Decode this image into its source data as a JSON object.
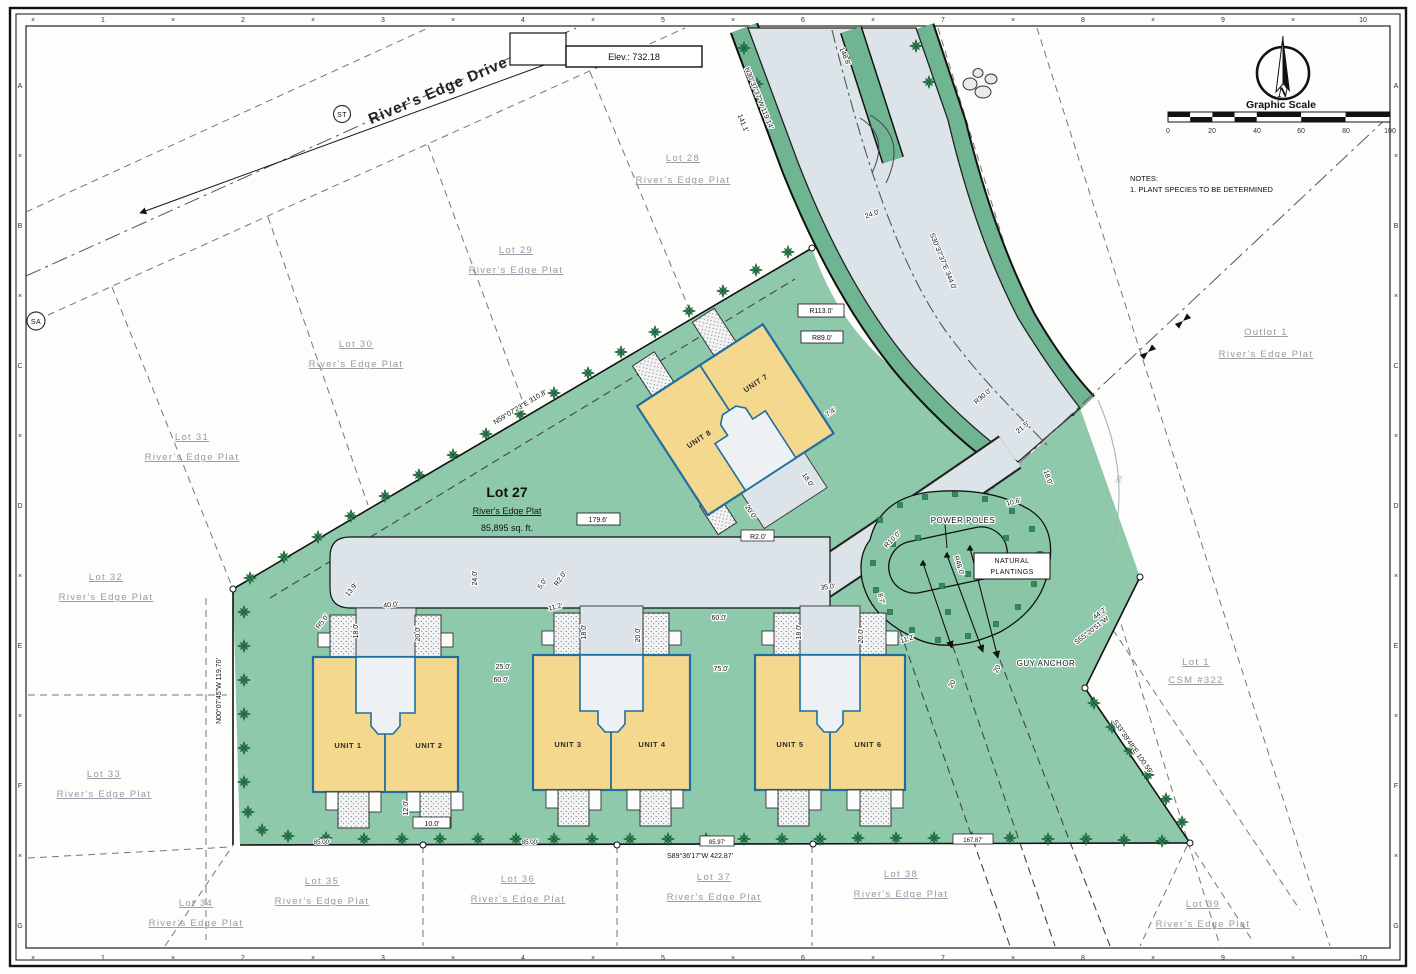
{
  "colors": {
    "lot_green": "#8fc9ab",
    "road_verge": "#6fb592",
    "pavement": "#dce4ea",
    "building": "#f4d88e",
    "building_outline": "#1f6f9e",
    "tree": "#2f8d57"
  },
  "frame": {
    "cross": "×",
    "top_numbers": [
      "1",
      "2",
      "3",
      "4",
      "5",
      "6",
      "7",
      "8",
      "9",
      "10"
    ],
    "side_letters": [
      "A",
      "B",
      "C",
      "D",
      "E",
      "F",
      "G"
    ]
  },
  "street": {
    "name": "River's Edge Drive",
    "st": "ST",
    "sa": "SA"
  },
  "benchmark": {
    "elevation": "Elev.: 732.18"
  },
  "north": {
    "n": "N"
  },
  "scale": {
    "title": "Graphic Scale",
    "ticks": [
      "0",
      "20",
      "40",
      "60",
      "80",
      "100"
    ]
  },
  "notes": {
    "heading": "NOTES:",
    "item1": "1.   PLANT SPECIES TO BE DETERMINED"
  },
  "lot27": {
    "name": "Lot 27",
    "plat": "River's Edge Plat",
    "area": "85,895 sq. ft."
  },
  "units": {
    "u1": "UNIT 1",
    "u2": "UNIT 2",
    "u3": "UNIT 3",
    "u4": "UNIT 4",
    "u5": "UNIT 5",
    "u6": "UNIT 6",
    "u7": "UNIT 7",
    "u8": "UNIT 8"
  },
  "features": {
    "power_poles": "POWER POLES",
    "natural_1": "NATURAL",
    "natural_2": "PLANTINGS",
    "guy_anchor": "GUY ANCHOR",
    "contour": "90"
  },
  "lots": {
    "lot28": {
      "name": "Lot 28",
      "plat": "River's Edge Plat"
    },
    "lot29": {
      "name": "Lot 29",
      "plat": "River's Edge Plat"
    },
    "lot30": {
      "name": "Lot 30",
      "plat": "River's Edge Plat"
    },
    "lot31": {
      "name": "Lot 31",
      "plat": "River's Edge Plat"
    },
    "lot32": {
      "name": "Lot 32",
      "plat": "River's Edge Plat"
    },
    "lot33": {
      "name": "Lot 33",
      "plat": "River's Edge Plat"
    },
    "lot34": {
      "name": "Lot 34",
      "plat": "River's Edge Plat"
    },
    "lot35": {
      "name": "Lot 35",
      "plat": "River's Edge Plat"
    },
    "lot36": {
      "name": "Lot 36",
      "plat": "River's Edge Plat"
    },
    "lot37": {
      "name": "Lot 37",
      "plat": "River's Edge Plat"
    },
    "lot38": {
      "name": "Lot 38",
      "plat": "River's Edge Plat"
    },
    "lot39": {
      "name": "Lot 39",
      "plat": "River's Edge Plat"
    },
    "outlot": {
      "name": "Outlot 1",
      "plat": "River's Edge Plat"
    },
    "lot1": {
      "name": "Lot 1",
      "plat": "CSM #322"
    }
  },
  "dims": {
    "road_len_148_8": "148.8'",
    "brg_nw": "N30°37'37\"W  119.14'",
    "len_141_1": "141.1'",
    "width_24_road": "24.0'",
    "brg_se_road": "S30°37'37\"E  344.0'",
    "r113": "R113.0'",
    "r89": "R89.0'",
    "d7_4": "7.4'",
    "d18_u7": "18.0'",
    "d20_u7": "20.0'",
    "r30": "R30.0'",
    "d21_5": "21.5'",
    "d18_road_end": "18.0'",
    "d10_6": "10.6'",
    "r10": "R10.0'",
    "r46": "R46.0'",
    "d8_7": "8.7'",
    "d11_2_e": "11.2'",
    "e20": "20",
    "d44_2": "44.2'",
    "brg_s55": "S55°20'51\"W",
    "brg_s33": "S33°39'48\"E  100.59'",
    "brg_n59": "N59°07'23\"E  310.8'",
    "brg_n00": "N00°07'45\"W  119.70'",
    "brg_s89": "S89°36'17\"W  422.87'",
    "seg_85": "85.00'",
    "seg_85_97": "85.97'",
    "seg_167": "167.87'",
    "d179_6": "179.6'",
    "d24_drive": "24.0'",
    "d13_9": "13.9'",
    "r5": "R5.0'",
    "d40": "40.0'",
    "d5": "5.0'",
    "r2": "R2.0'",
    "d11_2_w": "11.2'",
    "d35": "35.0'",
    "d18_court": "18.0'",
    "d20_court": "20.0'",
    "d25": "25.0'",
    "d60": "60.0'",
    "d75": "75.0'",
    "d12": "12.0'",
    "d10": "10.0'"
  }
}
